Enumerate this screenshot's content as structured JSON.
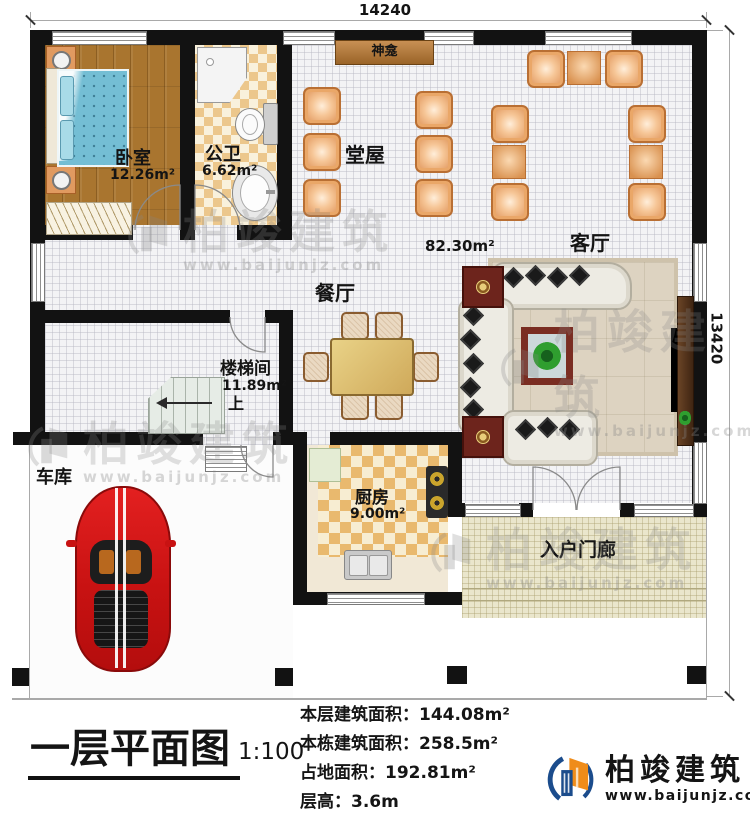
{
  "dimensions": {
    "top": "14240",
    "right": "13420"
  },
  "rooms": {
    "bedroom": {
      "name": "卧室",
      "area": "12.26m²"
    },
    "bathroom": {
      "name": "公卫",
      "area": "6.62m²"
    },
    "shrine": {
      "name": "神龛"
    },
    "hall": {
      "name": "堂屋",
      "area": "82.30m²"
    },
    "living": {
      "name": "客厅"
    },
    "dining": {
      "name": "餐厅"
    },
    "stairwell": {
      "name": "楼梯间",
      "area": "11.89m²",
      "up_label": "上"
    },
    "garage": {
      "name": "车库"
    },
    "kitchen": {
      "name": "厨房",
      "area": "9.00m²"
    },
    "porch": {
      "name": "入户门廊"
    }
  },
  "title_block": {
    "title": "一层平面图",
    "scale": "1:100",
    "stats": [
      {
        "label": "本层建筑面积：",
        "value": "144.08m²"
      },
      {
        "label": "本栋建筑面积：",
        "value": "258.5m²"
      },
      {
        "label": "占地面积：",
        "value": "192.81m²"
      },
      {
        "label": "层高：",
        "value": "3.6m"
      }
    ]
  },
  "brand": {
    "name": "柏竣建筑",
    "website": "www.baijunjz.com"
  },
  "watermark": {
    "text": "柏竣建筑",
    "url": "www.baijunjz.com"
  },
  "colors": {
    "brand_blue": "#1b4c8c",
    "brand_orange": "#ef8c1a",
    "wall": "#121212",
    "car_red": "#cf1414",
    "chair_orange": "#e39a5c"
  }
}
